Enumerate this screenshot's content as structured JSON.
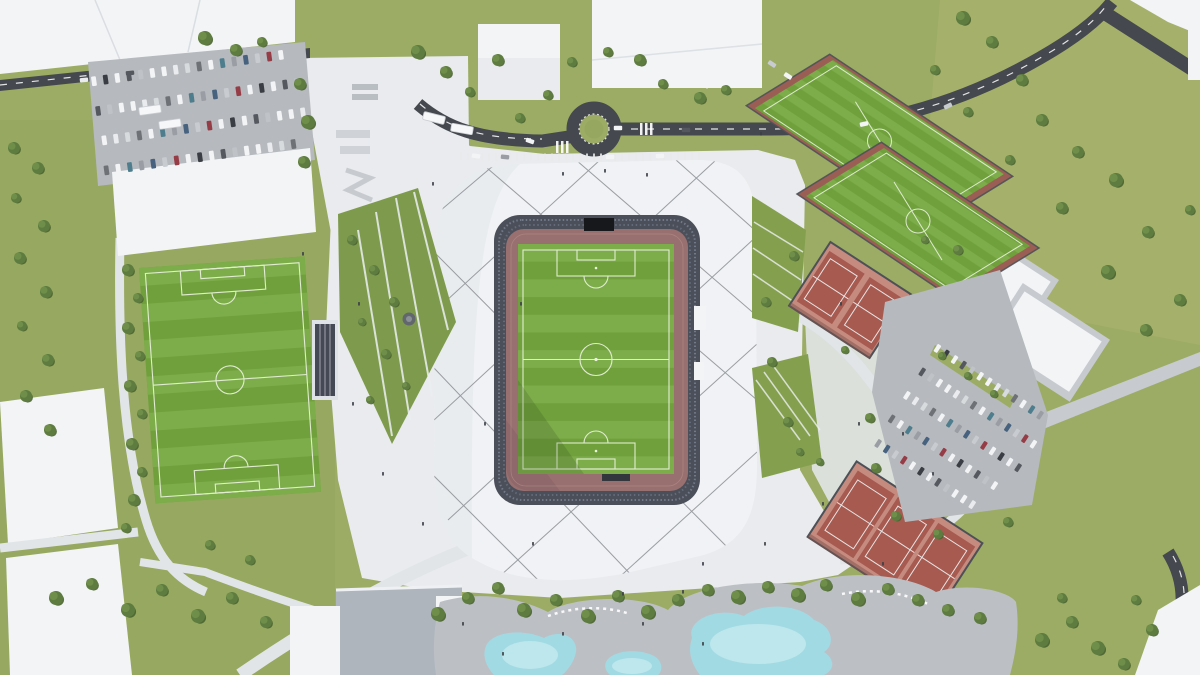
{
  "scene": {
    "type": "aerial-architectural-rendering",
    "subject": "stadium and sports complex masterplan",
    "features": [
      "main stadium with athletics track",
      "training football pitches",
      "tennis courts",
      "parking lots",
      "leisure pools",
      "roundabout road",
      "landscaped plazas"
    ]
  },
  "colors": {
    "grass_base": "#9CAC64",
    "grass_left": "#93A55C",
    "meadow": "#A7B26C",
    "road": "#45484E",
    "road_line": "#F4F5F6",
    "plaza": "#E9EBEE",
    "plaza_path": "#E2E5E8",
    "roof": "#F0F2F5",
    "roof_shade": "#E4E7EB",
    "cable": "#85888D",
    "bowl": "#4B4F5A",
    "bowl_rows_light": "#7A8090",
    "bowl_rows_mid": "#6A707E",
    "bowl_rows_dark": "#596071",
    "scoreboard": "#17181C",
    "track": "#997070",
    "track_shadow": "#7C595E",
    "pitch": "#6FA03C",
    "pitch_stripe": "#7DAD4A",
    "line_white": "#EAF2DC",
    "training_border": "#9A5E55",
    "fence": "#4D5157",
    "tennis_pad": "#C68B7F",
    "tennis_court": "#A65A50",
    "building": "#F2F4F6",
    "building_shade": "#D8DBDF",
    "apron": "#C7CACF",
    "asphalt": "#B6B9BD",
    "deck": "#BCC0C5",
    "terrace": "#AEB5BD",
    "pool": "#A2DAE4",
    "pool_light": "#C9ECF1",
    "green_patch": "#84A04F",
    "diamond_green": "#7E9B4D",
    "island_green": "#96A75F",
    "tree": "#5E7C40",
    "tree_light": "#6F8E4A",
    "tree_shadow": "#49622F",
    "stand_frame": "#DFE2E6",
    "stand_dark": "#454956",
    "people": "#3C4046",
    "bus": "#F6F7F8"
  },
  "car_palette": [
    "#F3F4F6",
    "#E9EBEE",
    "#C8CBD0",
    "#F3F4F6",
    "#9A9EA4",
    "#55595F",
    "#F3F4F6",
    "#3A3E44",
    "#D8DBDE",
    "#963C46",
    "#F3F4F6",
    "#46627F",
    "#BFC3C7",
    "#4E7E8D",
    "#F3F4F6",
    "#6E7277"
  ],
  "stripes": {
    "stadium_pitch": {
      "x": 518,
      "y": 244,
      "w": 156,
      "h": 230,
      "n": 13
    },
    "left_pitch": {
      "x": 147,
      "y": 262,
      "w": 166,
      "h": 236,
      "n": 13
    }
  },
  "cables": [
    [
      434,
      312,
      600,
      160
    ],
    [
      434,
      420,
      716,
      160
    ],
    [
      448,
      520,
      757,
      236
    ],
    [
      500,
      576,
      757,
      344
    ],
    [
      614,
      582,
      757,
      452
    ],
    [
      434,
      216,
      500,
      160
    ],
    [
      480,
      162,
      757,
      400
    ],
    [
      576,
      160,
      757,
      316
    ],
    [
      676,
      160,
      757,
      232
    ],
    [
      434,
      252,
      740,
      560
    ],
    [
      434,
      368,
      636,
      580
    ],
    [
      434,
      476,
      544,
      586
    ]
  ],
  "parking_topleft": {
    "rot": -8,
    "ox": 200,
    "oy": 120,
    "dx": 11.8,
    "w": 4.8,
    "h": 9.6,
    "rows": [
      {
        "y": 62,
        "x0": 98,
        "n": 17
      },
      {
        "y": 92,
        "x0": 98,
        "n": 18
      },
      {
        "y": 122,
        "x0": 100,
        "n": 18
      },
      {
        "y": 152,
        "x0": 98,
        "n": 17
      }
    ]
  },
  "parking_right": {
    "rot": 33,
    "ox": 960,
    "oy": 420,
    "dx": 10.2,
    "w": 4.2,
    "h": 8.6,
    "rows": [
      {
        "y": 368,
        "x0": 900,
        "n": 13
      },
      {
        "y": 396,
        "x0": 900,
        "n": 14
      },
      {
        "y": 424,
        "x0": 900,
        "n": 14
      },
      {
        "y": 452,
        "x0": 900,
        "n": 13
      },
      {
        "y": 480,
        "x0": 902,
        "n": 12
      }
    ]
  },
  "road_cars": [
    [
      530,
      141,
      20,
      0
    ],
    [
      618,
      128,
      0,
      3
    ],
    [
      686,
      130,
      0,
      5
    ],
    [
      864,
      124,
      -12,
      0
    ],
    [
      948,
      106,
      -25,
      2
    ],
    [
      476,
      156,
      8,
      0
    ],
    [
      505,
      157,
      5,
      4
    ],
    [
      610,
      157,
      0,
      0
    ],
    [
      660,
      156,
      -3,
      6
    ],
    [
      84,
      80,
      -6,
      1
    ],
    [
      130,
      73,
      -6,
      5
    ],
    [
      757,
      52,
      33,
      0
    ],
    [
      772,
      64,
      33,
      2
    ],
    [
      788,
      76,
      33,
      0
    ]
  ],
  "buses": [
    [
      434,
      118,
      14
    ],
    [
      462,
      129,
      10
    ],
    [
      150,
      110,
      -8
    ],
    [
      170,
      124,
      -8
    ]
  ],
  "trees": [
    [
      205,
      38,
      7
    ],
    [
      236,
      50,
      6
    ],
    [
      262,
      42,
      5
    ],
    [
      300,
      84,
      6
    ],
    [
      308,
      122,
      7
    ],
    [
      304,
      162,
      6
    ],
    [
      418,
      52,
      7
    ],
    [
      446,
      72,
      6
    ],
    [
      470,
      92,
      5
    ],
    [
      498,
      60,
      6
    ],
    [
      520,
      118,
      5
    ],
    [
      548,
      95,
      5
    ],
    [
      572,
      62,
      5
    ],
    [
      608,
      52,
      5
    ],
    [
      640,
      60,
      6
    ],
    [
      663,
      84,
      5
    ],
    [
      700,
      98,
      6
    ],
    [
      726,
      90,
      5
    ],
    [
      963,
      18,
      7
    ],
    [
      992,
      42,
      6
    ],
    [
      1022,
      80,
      6
    ],
    [
      968,
      112,
      5
    ],
    [
      1042,
      120,
      6
    ],
    [
      1078,
      152,
      6
    ],
    [
      1116,
      180,
      7
    ],
    [
      1062,
      208,
      6
    ],
    [
      1148,
      232,
      6
    ],
    [
      1108,
      272,
      7
    ],
    [
      1180,
      300,
      6
    ],
    [
      1146,
      330,
      6
    ],
    [
      1190,
      210,
      5
    ],
    [
      935,
      70,
      5
    ],
    [
      1010,
      160,
      5
    ],
    [
      958,
      250,
      5
    ],
    [
      14,
      148,
      6
    ],
    [
      38,
      168,
      6
    ],
    [
      16,
      198,
      5
    ],
    [
      44,
      226,
      6
    ],
    [
      20,
      258,
      6
    ],
    [
      46,
      292,
      6
    ],
    [
      22,
      326,
      5
    ],
    [
      48,
      360,
      6
    ],
    [
      26,
      396,
      6
    ],
    [
      50,
      430,
      6
    ],
    [
      128,
      270,
      6
    ],
    [
      138,
      298,
      5
    ],
    [
      128,
      328,
      6
    ],
    [
      140,
      356,
      5
    ],
    [
      130,
      386,
      6
    ],
    [
      142,
      414,
      5
    ],
    [
      132,
      444,
      6
    ],
    [
      142,
      472,
      5
    ],
    [
      134,
      500,
      6
    ],
    [
      126,
      528,
      5
    ],
    [
      352,
      240,
      5
    ],
    [
      374,
      270,
      5
    ],
    [
      394,
      302,
      5
    ],
    [
      362,
      322,
      4
    ],
    [
      386,
      354,
      5
    ],
    [
      406,
      386,
      4
    ],
    [
      370,
      400,
      4
    ],
    [
      438,
      614,
      7
    ],
    [
      468,
      598,
      6
    ],
    [
      498,
      588,
      6
    ],
    [
      524,
      610,
      7
    ],
    [
      556,
      600,
      6
    ],
    [
      588,
      616,
      7
    ],
    [
      618,
      596,
      6
    ],
    [
      648,
      612,
      7
    ],
    [
      678,
      600,
      6
    ],
    [
      708,
      590,
      6
    ],
    [
      738,
      597,
      7
    ],
    [
      768,
      587,
      6
    ],
    [
      798,
      595,
      7
    ],
    [
      826,
      585,
      6
    ],
    [
      858,
      599,
      7
    ],
    [
      888,
      589,
      6
    ],
    [
      918,
      600,
      6
    ],
    [
      948,
      610,
      6
    ],
    [
      980,
      618,
      6
    ],
    [
      56,
      598,
      7
    ],
    [
      92,
      584,
      6
    ],
    [
      128,
      610,
      7
    ],
    [
      162,
      590,
      6
    ],
    [
      198,
      616,
      7
    ],
    [
      232,
      598,
      6
    ],
    [
      266,
      622,
      6
    ],
    [
      250,
      560,
      5
    ],
    [
      210,
      545,
      5
    ],
    [
      1042,
      640,
      7
    ],
    [
      1072,
      622,
      6
    ],
    [
      1098,
      648,
      7
    ],
    [
      1124,
      664,
      6
    ],
    [
      1136,
      600,
      5
    ],
    [
      1152,
      630,
      6
    ],
    [
      1062,
      598,
      5
    ],
    [
      870,
      418,
      5
    ],
    [
      876,
      468,
      5
    ],
    [
      896,
      516,
      5
    ],
    [
      938,
      534,
      5
    ],
    [
      1008,
      522,
      5
    ],
    [
      942,
      356,
      4
    ],
    [
      968,
      376,
      4
    ],
    [
      994,
      394,
      4
    ],
    [
      794,
      256,
      5
    ],
    [
      766,
      302,
      5
    ],
    [
      772,
      362,
      5
    ],
    [
      788,
      422,
      5
    ],
    [
      800,
      452,
      4
    ],
    [
      820,
      462,
      4
    ],
    [
      845,
      350,
      4
    ],
    [
      925,
      240,
      4
    ]
  ],
  "people": [
    [
      562,
      172
    ],
    [
      604,
      169
    ],
    [
      646,
      173
    ],
    [
      520,
      302
    ],
    [
      484,
      422
    ],
    [
      532,
      542
    ],
    [
      702,
      562
    ],
    [
      764,
      542
    ],
    [
      822,
      502
    ],
    [
      858,
      422
    ],
    [
      840,
      302
    ],
    [
      622,
      592
    ],
    [
      682,
      590
    ],
    [
      422,
      522
    ],
    [
      382,
      472
    ],
    [
      352,
      402
    ],
    [
      302,
      252
    ],
    [
      432,
      182
    ],
    [
      902,
      432
    ],
    [
      932,
      472
    ],
    [
      760,
      132
    ],
    [
      642,
      622
    ],
    [
      702,
      642
    ],
    [
      562,
      632
    ],
    [
      502,
      652
    ],
    [
      462,
      622
    ],
    [
      882,
      562
    ],
    [
      358,
      302
    ]
  ]
}
